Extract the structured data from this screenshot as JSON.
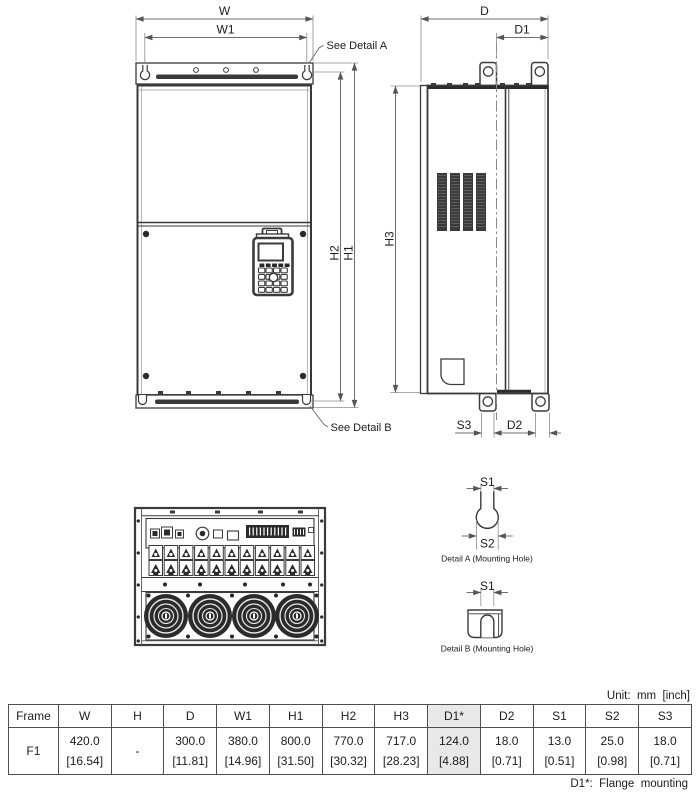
{
  "unit_note": "Unit:  mm  [inch]",
  "footnote": "D1*:  Flange  mounting",
  "labels": {
    "w": "W",
    "w1": "W1",
    "d": "D",
    "d1": "D1",
    "h1": "H1",
    "h2": "H2",
    "h3": "H3",
    "s1": "S1",
    "s2": "S2",
    "s3": "S3",
    "d2": "D2",
    "see_detail_a": "See Detail A",
    "see_detail_b": "See Detail B",
    "detail_a_caption": "Detail A (Mounting Hole)",
    "detail_b_caption": "Detail B (Mounting Hole)"
  },
  "table": {
    "headers": [
      "Frame",
      "W",
      "H",
      "D",
      "W1",
      "H1",
      "H2",
      "H3",
      "D1*",
      "D2",
      "S1",
      "S2",
      "S3"
    ],
    "frame": "F1",
    "mm": [
      "420.0",
      "-",
      "300.0",
      "380.0",
      "800.0",
      "770.0",
      "717.0",
      "124.0",
      "18.0",
      "13.0",
      "25.0",
      "18.0"
    ],
    "inch": [
      "[16.54]",
      "",
      "[11.81]",
      "[14.96]",
      "[31.50]",
      "[30.32]",
      "[28.23]",
      "[4.88]",
      "[0.71]",
      "[0.51]",
      "[0.98]",
      "[0.71]"
    ]
  },
  "colors": {
    "line": "#3b3b3b",
    "dim_line": "#707070",
    "dark_fill": "#2b2b2b",
    "highlight": "#e8e8e8",
    "background": "#ffffff"
  }
}
